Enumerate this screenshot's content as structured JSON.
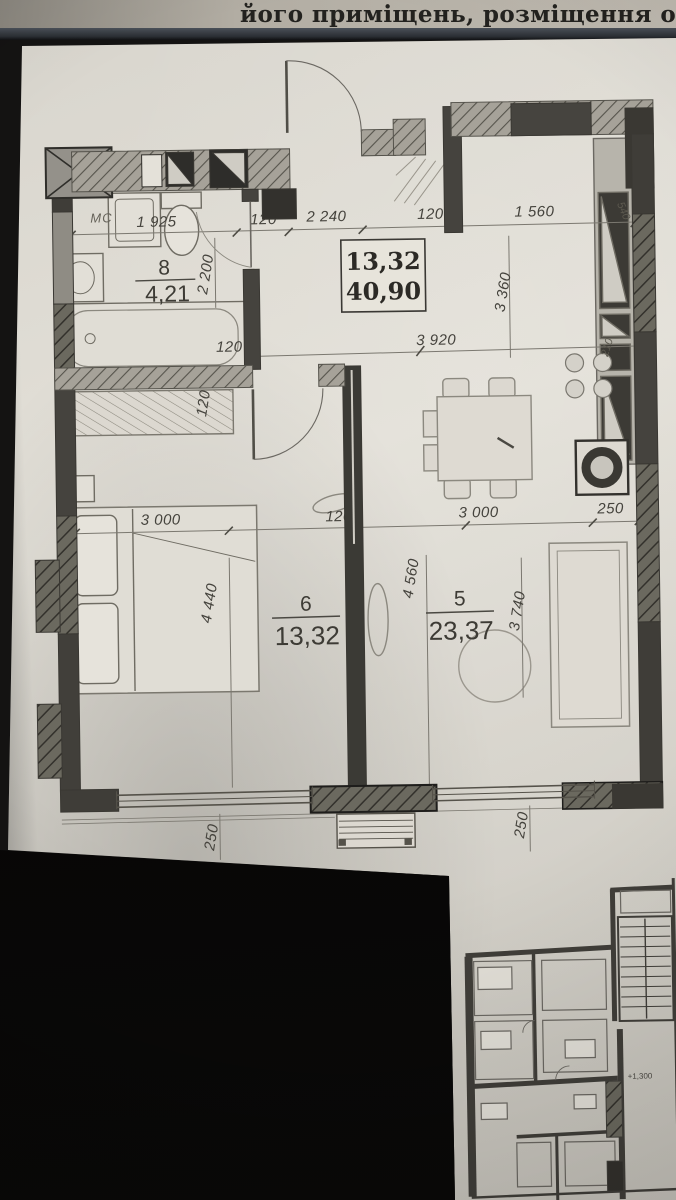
{
  "header": {
    "title": "його приміщень, розміщення об"
  },
  "plan": {
    "summary_box": {
      "area_top": "13,32",
      "area_bottom": "40,90"
    },
    "rooms": [
      {
        "number": "8",
        "area": "4,21"
      },
      {
        "number": "6",
        "area": "13,32"
      },
      {
        "number": "5",
        "area": "23,37"
      }
    ],
    "labels": {
      "mc": "МС"
    },
    "dims": {
      "top": [
        "1 925",
        "120",
        "2 240",
        "120",
        "1 560"
      ],
      "mid_row": [
        "3 000",
        "120",
        "3 000",
        "250"
      ],
      "h3920": "3 920",
      "v2200": "2 200",
      "v3360": "3 360",
      "v4440": "4 440",
      "v4560": "4 560",
      "v3740": "3 740",
      "h120_left": "120",
      "v120_left": "120",
      "v250_bottom_left": "250",
      "v250_bottom_right": "250",
      "v540_top_right": "540",
      "v210_right": "210"
    }
  },
  "mini_plan": {
    "elevation_mark": "+1,300"
  }
}
